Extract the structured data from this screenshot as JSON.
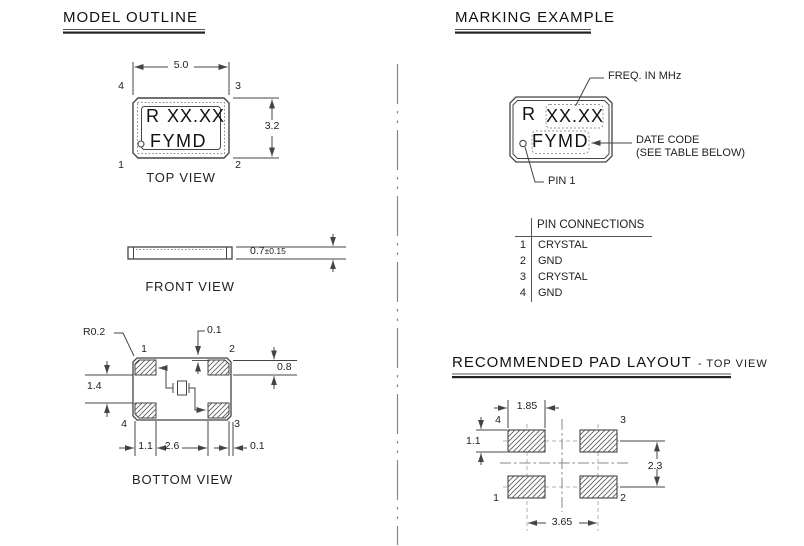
{
  "colors": {
    "line": "#444444",
    "text": "#1a1a1a",
    "dash_box": "#999999"
  },
  "model_outline": {
    "heading": "MODEL OUTLINE",
    "top_view": {
      "label": "TOP VIEW",
      "width": "5.0",
      "height": "3.2",
      "prefix": "R",
      "freq": "XX.XX",
      "date_code": "FYMD",
      "pin_tl": "4",
      "pin_tr": "3",
      "pin_bl": "1",
      "pin_br": "2"
    },
    "front_view": {
      "label": "FRONT VIEW",
      "thickness": "0.7",
      "tolerance": "±0.15"
    },
    "bottom_view": {
      "label": "BOTTOM VIEW",
      "corner_radius": "R0.2",
      "pad_top_offset": "0.1",
      "pad_height": "0.8",
      "pad_vertical_gap": "1.4",
      "pad_width": "1.1",
      "pad_center_gap": "2.6",
      "pad_side_offset": "0.1",
      "pin_tl": "1",
      "pin_tr": "2",
      "pin_bl": "4",
      "pin_br": "3"
    }
  },
  "marking_example": {
    "heading": "MARKING EXAMPLE",
    "prefix": "R",
    "freq": "XX.XX",
    "date_code": "FYMD",
    "callout_freq": "FREQ. IN MHz",
    "callout_date_code": "DATE CODE",
    "callout_date_code_note": "(SEE TABLE BELOW)",
    "callout_pin1": "PIN 1"
  },
  "pin_connections": {
    "title": "PIN CONNECTIONS",
    "rows": [
      {
        "pin": "1",
        "signal": "CRYSTAL"
      },
      {
        "pin": "2",
        "signal": "GND"
      },
      {
        "pin": "3",
        "signal": "CRYSTAL"
      },
      {
        "pin": "4",
        "signal": "GND"
      }
    ]
  },
  "pad_layout": {
    "heading": "RECOMMENDED PAD LAYOUT",
    "heading_suffix": "- TOP VIEW",
    "pad_width": "1.85",
    "pad_height": "1.1",
    "row_pitch": "2.3",
    "column_pitch": "3.65",
    "pin_tl": "4",
    "pin_tr": "3",
    "pin_bl": "1",
    "pin_br": "2"
  }
}
